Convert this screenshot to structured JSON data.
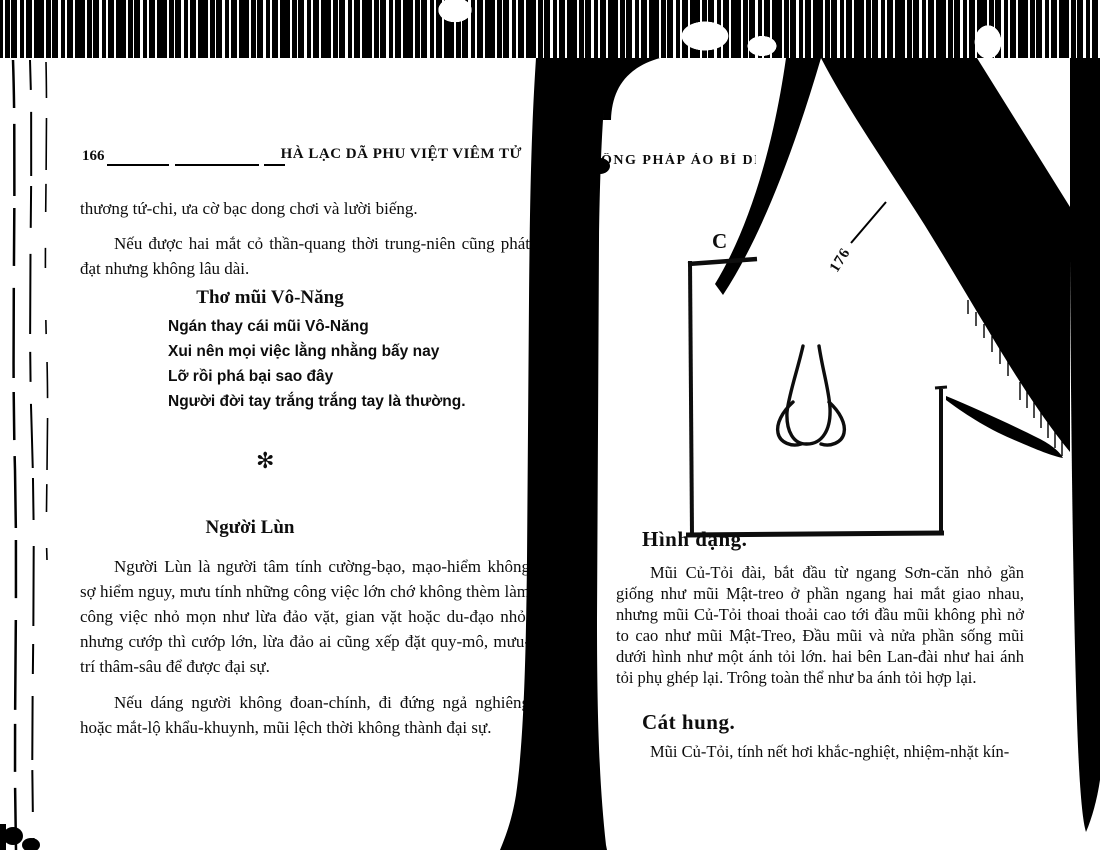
{
  "colors": {
    "ink": "#0d0d0d",
    "paper": "#ffffff"
  },
  "left_page": {
    "page_number": "166",
    "header_title": "HÀ LẠC DÃ PHU VIỆT VIÊM TỬ",
    "para_continuation": "thương tứ-chi, ưa cờ bạc dong chơi và lười biếng.",
    "para2": "Nếu được hai mắt cỏ thần-quang thời trung-niên cũng phát đạt nhưng không lâu dài.",
    "poem_title": "Thơ mũi Vô-Năng",
    "poem_lines": [
      "Ngán thay cái mũi Vô-Năng",
      "Xui nên mọi việc lằng nhằng bấy nay",
      "Lỡ rồi phá bại sao đây",
      "Người đời tay trắng trắng tay là thường."
    ],
    "divider_glyph": "✻",
    "section_title": "Người Lùn",
    "section_para1": "Người Lùn là người tâm tính cường-bạo, mạo-hiểm không sợ hiểm nguy, mưu tính những công việc lớn chớ không thèm làm công việc nhỏ mọn như lừa đảo vặt, gian vặt hoặc du-đạo nhỏ, nhưng cướp thì cướp lớn, lừa đảo ai cũng xếp đặt quy-mô, mưu-trí thâm-sâu để được đại sự.",
    "section_para2": "Nếu dáng người không đoan-chính, đi đứng ngả nghiêng hoặc mắt-lộ khẩu-khuynh, mũi lệch thời không thành đại sự."
  },
  "right_page": {
    "header_fragment": "ỒNG PHÁP ẢO BÍ DIỆN",
    "figure_label_fragment": "C",
    "fold_page_number": "176",
    "section1_title": "Hình dạng.",
    "section1_body": "Mũi Củ-Tỏi đài, bắt đầu từ ngang Sơn-căn nhỏ gần giống như mũi Mật-treo ở phần ngang hai mắt giao nhau, nhưng mũi Củ-Tỏi thoai thoải cao tới đầu mũi không phì nở to cao như mũi Mật-Treo, Đầu mũi và nửa phần sống mũi dưới hình như một ánh tỏi lớn. hai bên Lan-đài như hai ánh tỏi phụ ghép lại. Trông toàn thể như ba ánh tỏi hợp lại.",
    "section2_title": "Cát hung.",
    "section2_body_fragment": "Mũi Củ-Tỏi, tính nết hơi khắc-nghiệt, nhiệm-nhặt kín-"
  }
}
